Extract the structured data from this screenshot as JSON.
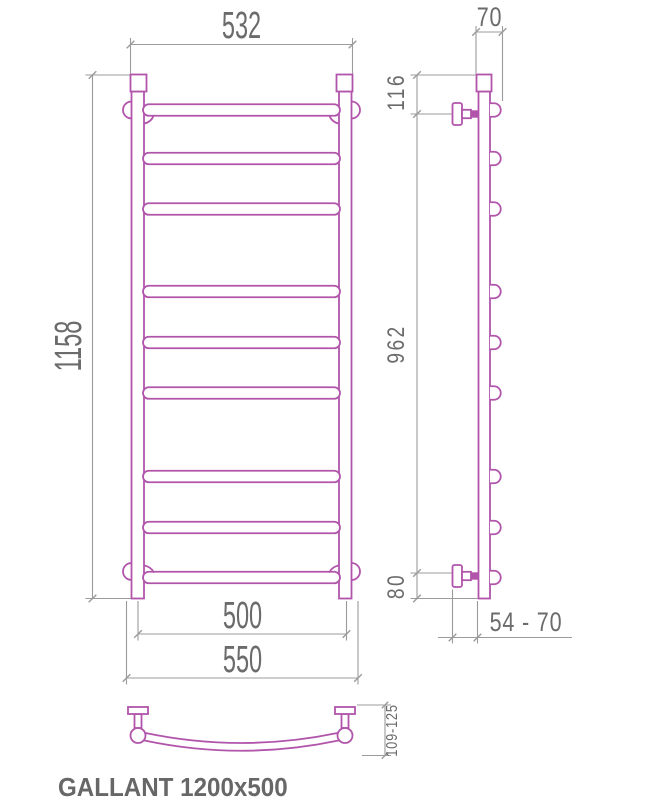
{
  "label": {
    "product_name": "GALLANT 1200x500"
  },
  "colors": {
    "line": "#b155ab",
    "dim": "#9b9b9b",
    "text": "#6b6b6b",
    "label": "#676767"
  },
  "dims": {
    "front": {
      "top_width": "532",
      "height": "1158",
      "bar_length": "500",
      "bottom_width": "550"
    },
    "side": {
      "depth": "70",
      "top_connection_offset": "116",
      "connection_span": "962",
      "bottom_connection_offset": "80",
      "wall_clearance": "54 - 70"
    },
    "bottom": {
      "arc_depth": "109-125"
    }
  },
  "drawing": {
    "kind": "technical drawing",
    "views": [
      "front",
      "side",
      "bottom"
    ],
    "bar_count": 9
  }
}
